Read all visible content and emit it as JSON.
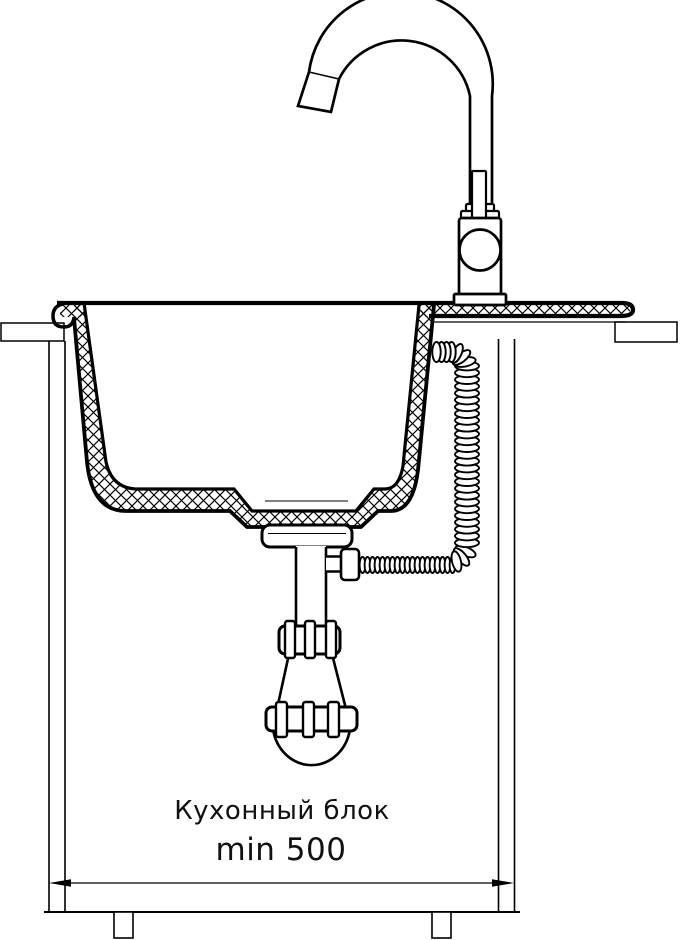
{
  "diagram": {
    "type": "technical-installation-drawing",
    "subject": "kitchen sink with faucet, siphon and cabinet cross-section",
    "labels": {
      "cabinet": "Кухонный блок",
      "min_width": "min 500"
    },
    "colors": {
      "line": "#000000",
      "background": "#ffffff"
    }
  }
}
